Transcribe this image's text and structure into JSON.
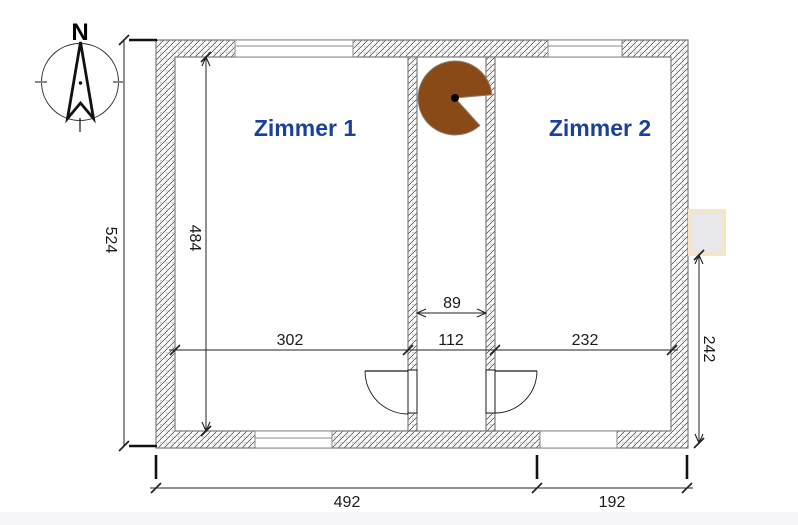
{
  "compass": {
    "north_label": "N"
  },
  "rooms": {
    "room1": {
      "label": "Zimmer 1"
    },
    "room2": {
      "label": "Zimmer 2"
    }
  },
  "dimensions": {
    "outer_height": "524",
    "inner_height": "484",
    "room1_inner_width": "302",
    "corridor_inner_width": "89",
    "corridor_outer_width": "112",
    "room2_inner_width": "232",
    "right_wall_segment_height": "242",
    "bottom_main_width": "492",
    "bottom_right_width": "192"
  },
  "colors": {
    "room_label_blue": "#1b429b",
    "sector_brown": "#8a4a17",
    "sector_outline": "#8d7f6f",
    "marker_beige": "#f3e6c9",
    "marker_fill": "#e8e8ec"
  }
}
